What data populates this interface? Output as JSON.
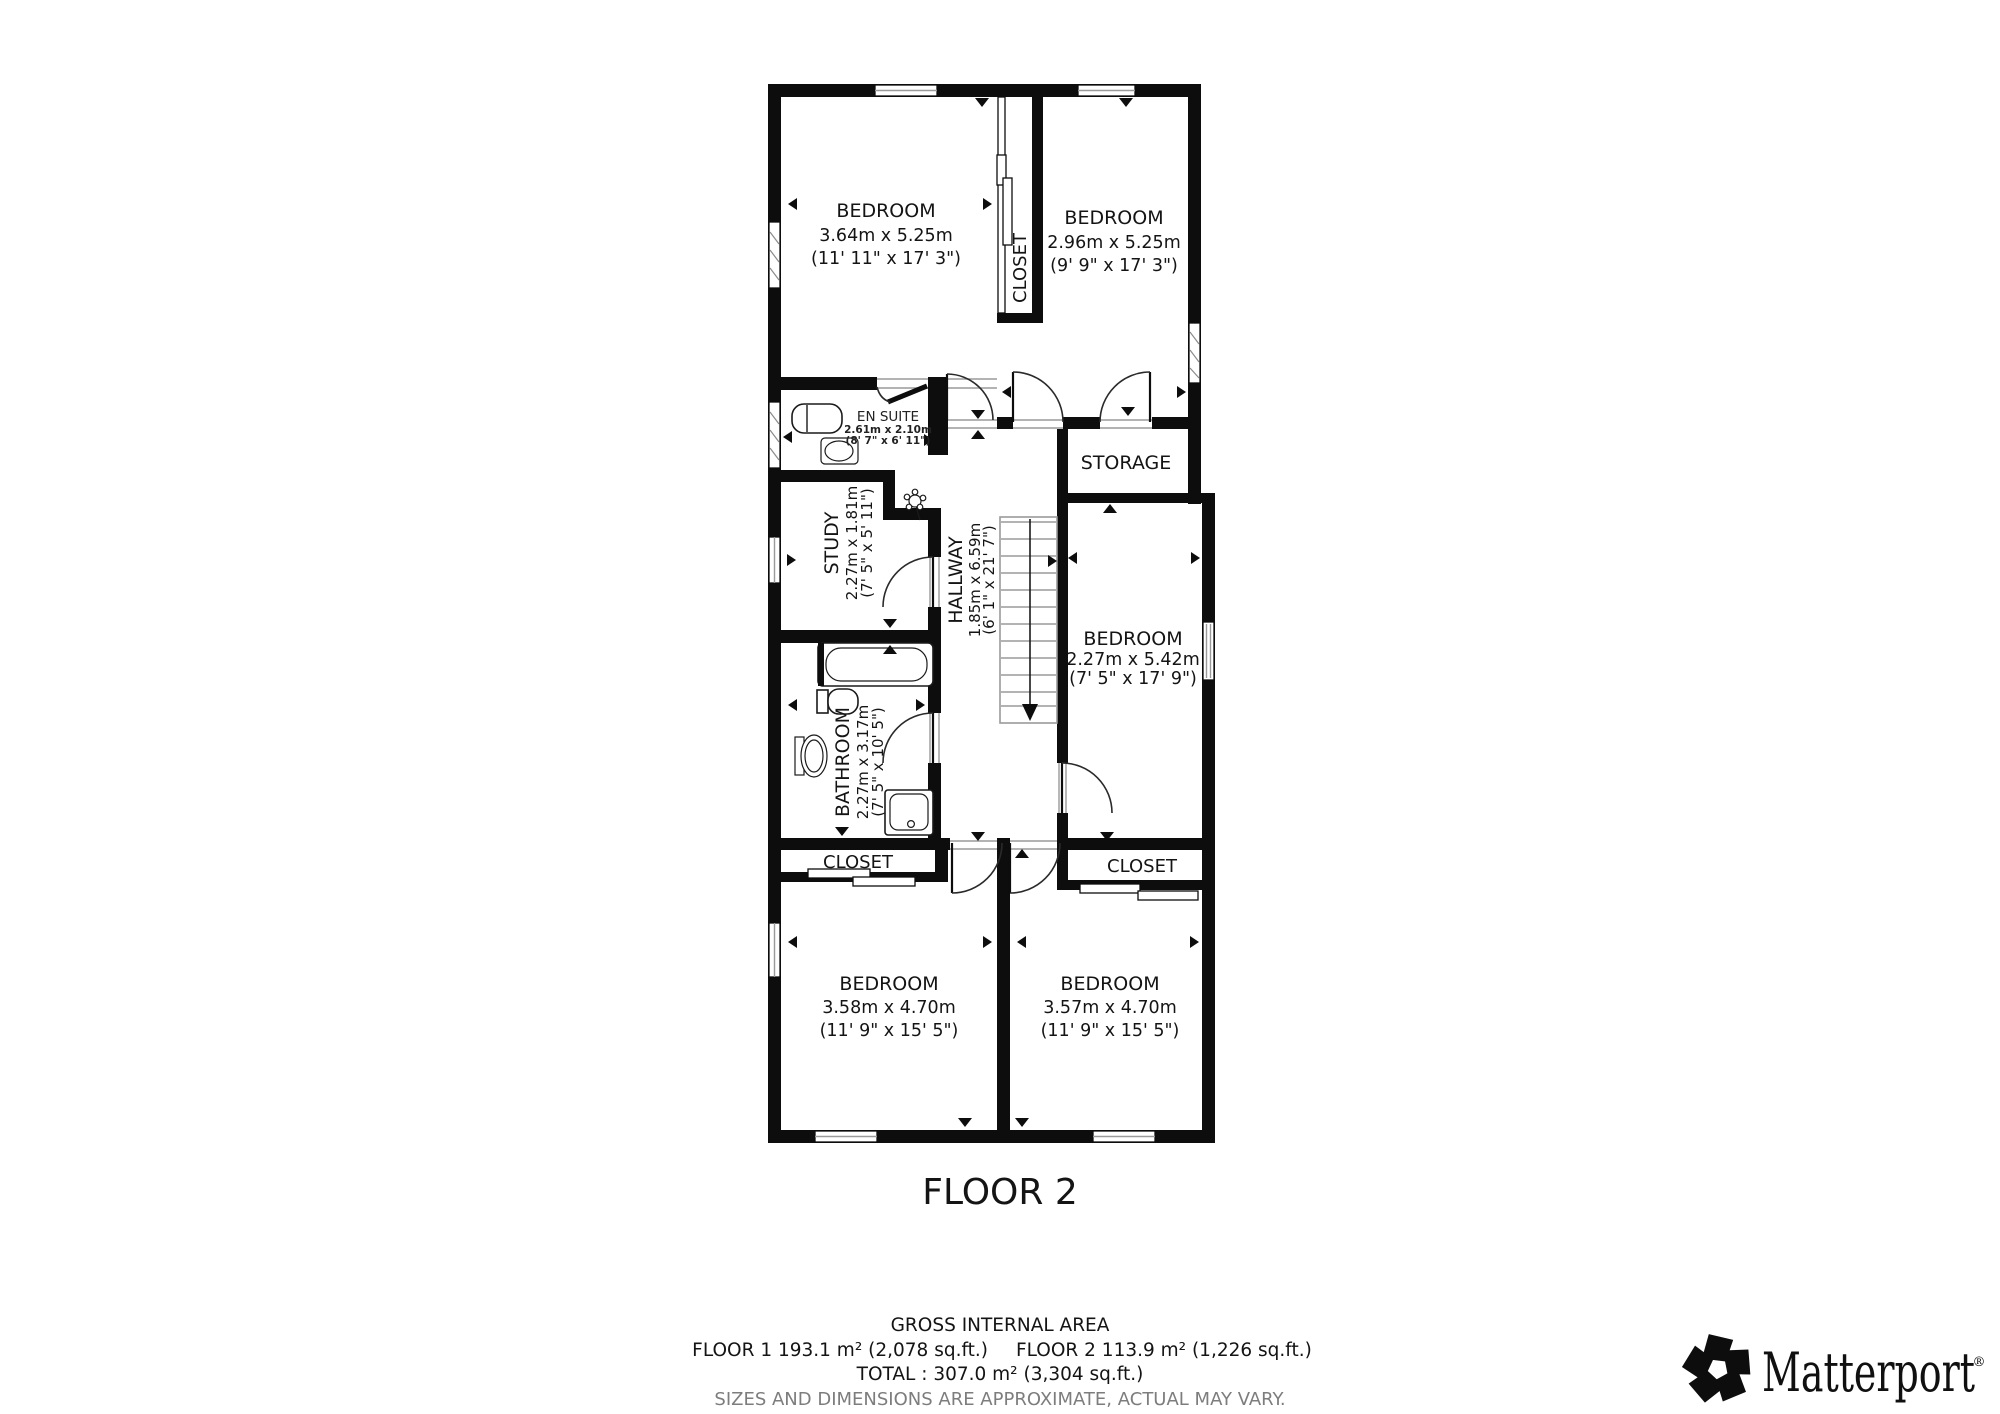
{
  "floor_title": "FLOOR 2",
  "rooms": {
    "bedroom_top_left": {
      "name": "BEDROOM",
      "metric": "3.64m x 5.25m",
      "imperial": "(11' 11\" x 17' 3\")"
    },
    "bedroom_top_right": {
      "name": "BEDROOM",
      "metric": "2.96m x 5.25m",
      "imperial": "(9' 9\" x 17' 3\")"
    },
    "closet_top": {
      "name": "CLOSET"
    },
    "en_suite": {
      "name": "EN SUITE",
      "metric": "2.61m x 2.10m",
      "imperial": "(8' 7\" x 6' 11\")"
    },
    "study": {
      "name": "STUDY",
      "metric": "2.27m x 1.81m",
      "imperial": "(7' 5\" x 5' 11\")"
    },
    "hallway": {
      "name": "HALLWAY",
      "metric": "1.85m x 6.59m",
      "imperial": "(6' 1\" x 21' 7\")"
    },
    "storage": {
      "name": "STORAGE"
    },
    "bedroom_right": {
      "name": "BEDROOM",
      "metric": "2.27m x 5.42m",
      "imperial": "(7' 5\" x 17' 9\")"
    },
    "bathroom": {
      "name": "BATHROOM",
      "metric": "2.27m x 3.17m",
      "imperial": "(7' 5\" x 10' 5\")"
    },
    "closet_bottom_left": {
      "name": "CLOSET"
    },
    "closet_bottom_right": {
      "name": "CLOSET"
    },
    "bedroom_bottom_left": {
      "name": "BEDROOM",
      "metric": "3.58m x 4.70m",
      "imperial": "(11' 9\" x 15' 5\")"
    },
    "bedroom_bottom_right": {
      "name": "BEDROOM",
      "metric": "3.57m x 4.70m",
      "imperial": "(11' 9\" x 15' 5\")"
    }
  },
  "footer": {
    "title": "GROSS INTERNAL AREA",
    "floor1": "FLOOR 1 193.1 m² (2,078 sq.ft.)",
    "floor2": "FLOOR 2 113.9 m² (1,226 sq.ft.)",
    "total": "TOTAL :  307.0 m² (3,304 sq.ft.)",
    "disclaimer": "SIZES AND DIMENSIONS ARE APPROXIMATE, ACTUAL MAY VARY."
  },
  "logo": {
    "brand": "Matterport",
    "registered": "®"
  },
  "colors": {
    "wall": "#0d0d0d",
    "text": "#141414",
    "muted_gray": "#7d7d7d",
    "thin_line": "#9a9a9a",
    "background": "#ffffff"
  }
}
